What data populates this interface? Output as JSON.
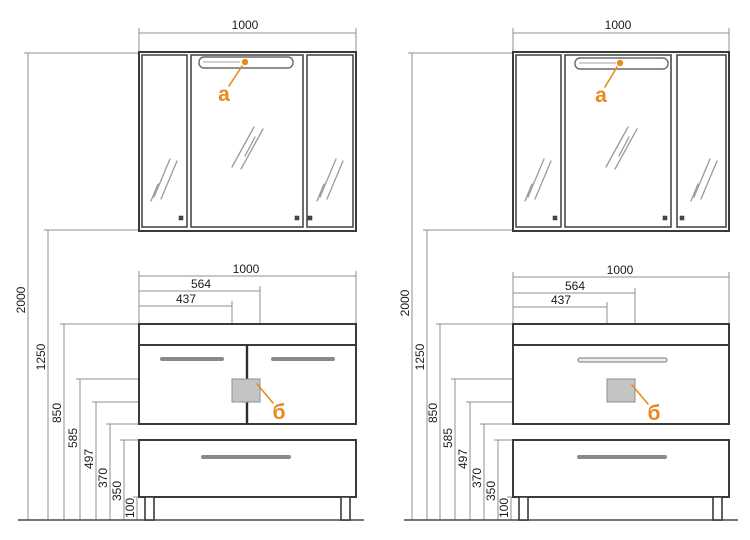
{
  "colors": {
    "accent_orange": "#e8891e",
    "outline_dark": "#3a3a3a",
    "dimension_line_gray": "#8f8f8f",
    "handle_gray": "#8a8a8a",
    "drain_square_fill": "#c4c4c4",
    "background": "#ffffff"
  },
  "diagrams": [
    {
      "variant": "vanity-with-two-doors",
      "mirror": {
        "width_dim": "1000",
        "light_label": "а"
      },
      "vanity": {
        "width_dim": "1000",
        "dim_564": "564",
        "dim_437": "437",
        "drain_label": "б"
      },
      "heights": [
        "2000",
        "1250",
        "850",
        "585",
        "497",
        "370",
        "350",
        "100"
      ]
    },
    {
      "variant": "vanity-with-drawer-front",
      "mirror": {
        "width_dim": "1000",
        "light_label": "а"
      },
      "vanity": {
        "width_dim": "1000",
        "dim_564": "564",
        "dim_437": "437",
        "drain_label": "б"
      },
      "heights": [
        "2000",
        "1250",
        "850",
        "585",
        "497",
        "370",
        "350",
        "100"
      ]
    }
  ]
}
